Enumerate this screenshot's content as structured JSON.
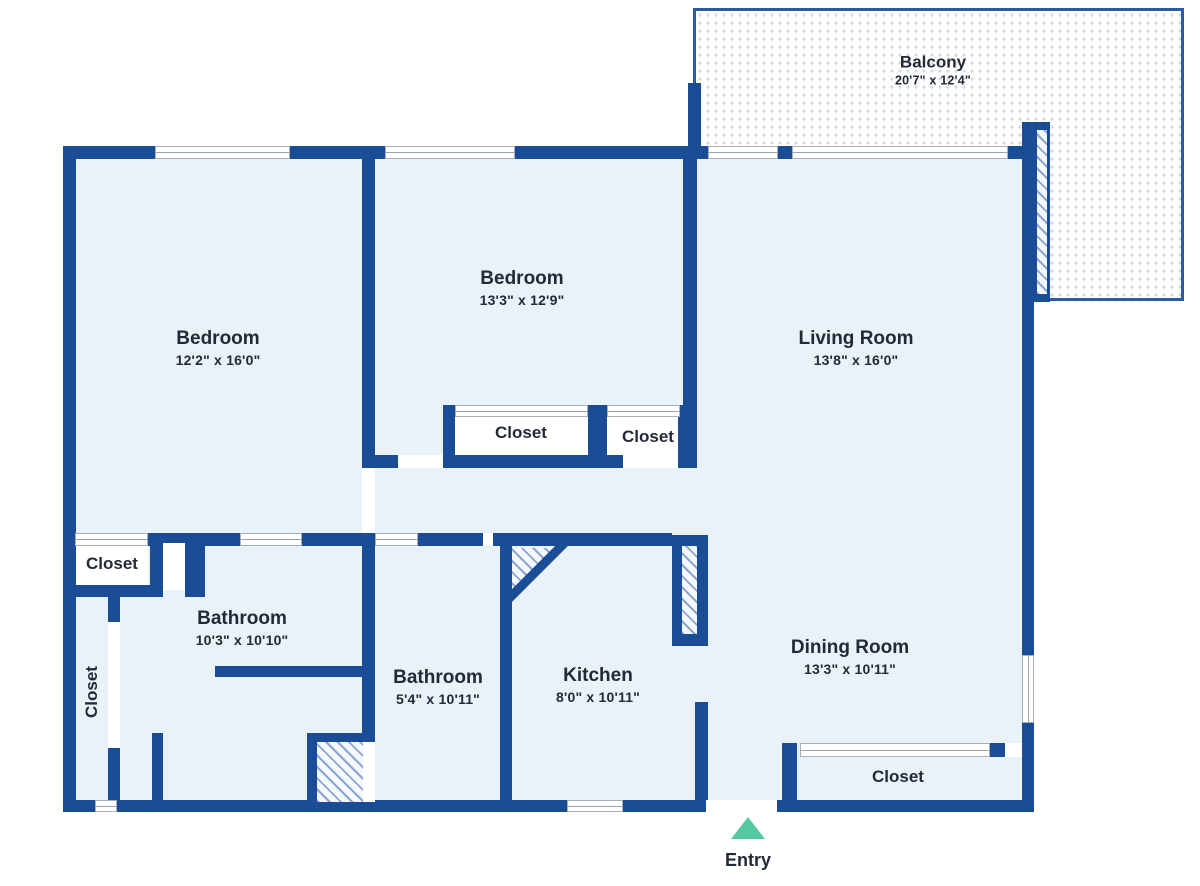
{
  "canvas": {
    "width": 1200,
    "height": 886
  },
  "colors": {
    "wall": "#1b4c96",
    "floor": "#e9f1f9",
    "closet_fill": "#ffffff",
    "window_line": "#9aa3af",
    "hatch_line": "#8ca6cf",
    "balcony_border": "#2c5ba6",
    "balcony_dot": "#d6dae1",
    "entry_arrow": "#57c9a1",
    "text": "#232a37"
  },
  "rooms": [
    {
      "key": "bedroom-left",
      "name": "Bedroom",
      "dims": "12'2\" x 16'0\"",
      "x": 218,
      "y": 348
    },
    {
      "key": "bedroom-middle",
      "name": "Bedroom",
      "dims": "13'3\" x 12'9\"",
      "x": 522,
      "y": 288
    },
    {
      "key": "living-room",
      "name": "Living Room",
      "dims": "13'8\" x 16'0\"",
      "x": 856,
      "y": 348
    },
    {
      "key": "balcony",
      "name": "Balcony",
      "dims": "20'7\" x 12'4\"",
      "x": 933,
      "y": 70,
      "balcony": true
    },
    {
      "key": "bathroom-main",
      "name": "Bathroom",
      "dims": "10'3\" x 10'10\"",
      "x": 242,
      "y": 628
    },
    {
      "key": "bathroom-second",
      "name": "Bathroom",
      "dims": "5'4\" x 10'11\"",
      "x": 438,
      "y": 687
    },
    {
      "key": "kitchen",
      "name": "Kitchen",
      "dims": "8'0\" x 10'11\"",
      "x": 598,
      "y": 685
    },
    {
      "key": "dining-room",
      "name": "Dining Room",
      "dims": "13'3\" x 10'11\"",
      "x": 850,
      "y": 657
    }
  ],
  "closets": [
    {
      "key": "closet-bedroom-middle",
      "label": "Closet",
      "x": 521,
      "y": 433,
      "vertical": false
    },
    {
      "key": "closet-bedroom-middle-2",
      "label": "Closet",
      "x": 648,
      "y": 437,
      "vertical": false
    },
    {
      "key": "closet-hall",
      "label": "Closet",
      "x": 112,
      "y": 564,
      "vertical": false
    },
    {
      "key": "closet-strip",
      "label": "Closet",
      "x": 92,
      "y": 692,
      "vertical": true
    },
    {
      "key": "closet-dining",
      "label": "Closet",
      "x": 898,
      "y": 777,
      "vertical": false
    }
  ],
  "entry": {
    "label": "Entry",
    "x": 748,
    "arrow_top": 817,
    "label_top": 850
  },
  "plan": {
    "balcony_rect": [
      693,
      8,
      491,
      293
    ],
    "balcony_door": {
      "frame": [
        1034,
        122,
        16,
        180
      ],
      "hatch": [
        1037,
        130,
        10,
        164
      ]
    },
    "floor_rects": [
      [
        63,
        146,
        971,
        666
      ]
    ],
    "closet_interiors": [
      [
        455,
        417,
        133,
        38
      ],
      [
        607,
        417,
        71,
        38
      ],
      [
        75,
        545,
        73,
        40
      ]
    ],
    "walls": [
      [
        63,
        146,
        92,
        13
      ],
      [
        290,
        146,
        95,
        13
      ],
      [
        515,
        146,
        178,
        13
      ],
      [
        693,
        146,
        15,
        13
      ],
      [
        778,
        146,
        14,
        13
      ],
      [
        1008,
        146,
        26,
        13
      ],
      [
        63,
        146,
        13,
        666
      ],
      [
        63,
        800,
        32,
        12
      ],
      [
        117,
        800,
        450,
        12
      ],
      [
        623,
        800,
        83,
        12
      ],
      [
        777,
        800,
        257,
        12
      ],
      [
        1022,
        122,
        12,
        533
      ],
      [
        1022,
        723,
        12,
        89
      ],
      [
        688,
        83,
        13,
        76
      ],
      [
        362,
        146,
        13,
        322
      ],
      [
        683,
        146,
        14,
        322
      ],
      [
        443,
        405,
        12,
        63
      ],
      [
        588,
        405,
        19,
        63
      ],
      [
        678,
        405,
        19,
        63
      ],
      [
        375,
        455,
        23,
        13
      ],
      [
        443,
        455,
        180,
        13
      ],
      [
        678,
        455,
        19,
        13
      ],
      [
        63,
        533,
        12,
        13
      ],
      [
        148,
        533,
        92,
        13
      ],
      [
        302,
        533,
        73,
        13
      ],
      [
        418,
        533,
        65,
        13
      ],
      [
        493,
        533,
        179,
        13
      ],
      [
        672,
        535,
        36,
        111
      ],
      [
        362,
        533,
        13,
        209
      ],
      [
        500,
        535,
        12,
        277
      ],
      [
        695,
        702,
        13,
        110
      ],
      [
        150,
        533,
        13,
        64
      ],
      [
        185,
        533,
        20,
        64
      ],
      [
        63,
        585,
        100,
        12
      ],
      [
        108,
        597,
        12,
        25
      ],
      [
        108,
        748,
        12,
        57
      ],
      [
        152,
        733,
        11,
        72
      ],
      [
        215,
        666,
        160,
        11
      ],
      [
        307,
        733,
        10,
        72
      ],
      [
        307,
        733,
        65,
        9
      ],
      [
        782,
        743,
        15,
        69
      ],
      [
        990,
        743,
        15,
        14
      ]
    ],
    "hatches": [
      [
        682,
        546,
        15,
        88
      ],
      [
        317,
        742,
        46,
        60
      ]
    ],
    "windows_h": [
      [
        155,
        146,
        135,
        13
      ],
      [
        385,
        146,
        130,
        13
      ],
      [
        708,
        146,
        70,
        13
      ],
      [
        792,
        146,
        216,
        13
      ],
      [
        95,
        800,
        22,
        12
      ],
      [
        567,
        800,
        56,
        12
      ],
      [
        455,
        405,
        133,
        12
      ],
      [
        607,
        405,
        73,
        12
      ],
      [
        75,
        533,
        73,
        13
      ],
      [
        240,
        533,
        62,
        13
      ],
      [
        375,
        533,
        43,
        13
      ],
      [
        800,
        743,
        190,
        14
      ]
    ],
    "windows_v": [
      [
        1022,
        655,
        12,
        68
      ]
    ],
    "door_gaps": [
      [
        362,
        468,
        13,
        65
      ],
      [
        398,
        455,
        45,
        13
      ],
      [
        623,
        455,
        55,
        13
      ],
      [
        483,
        533,
        10,
        13
      ],
      [
        706,
        800,
        71,
        12
      ],
      [
        163,
        543,
        22,
        47
      ],
      [
        108,
        622,
        12,
        126
      ],
      [
        363,
        742,
        12,
        60
      ],
      [
        1005,
        743,
        17,
        14
      ]
    ],
    "diagonal": {
      "cx": 536,
      "cy": 571,
      "length": 92,
      "thickness": 9
    },
    "corner_hatch_triangle": [
      512,
      548,
      48,
      48
    ]
  }
}
